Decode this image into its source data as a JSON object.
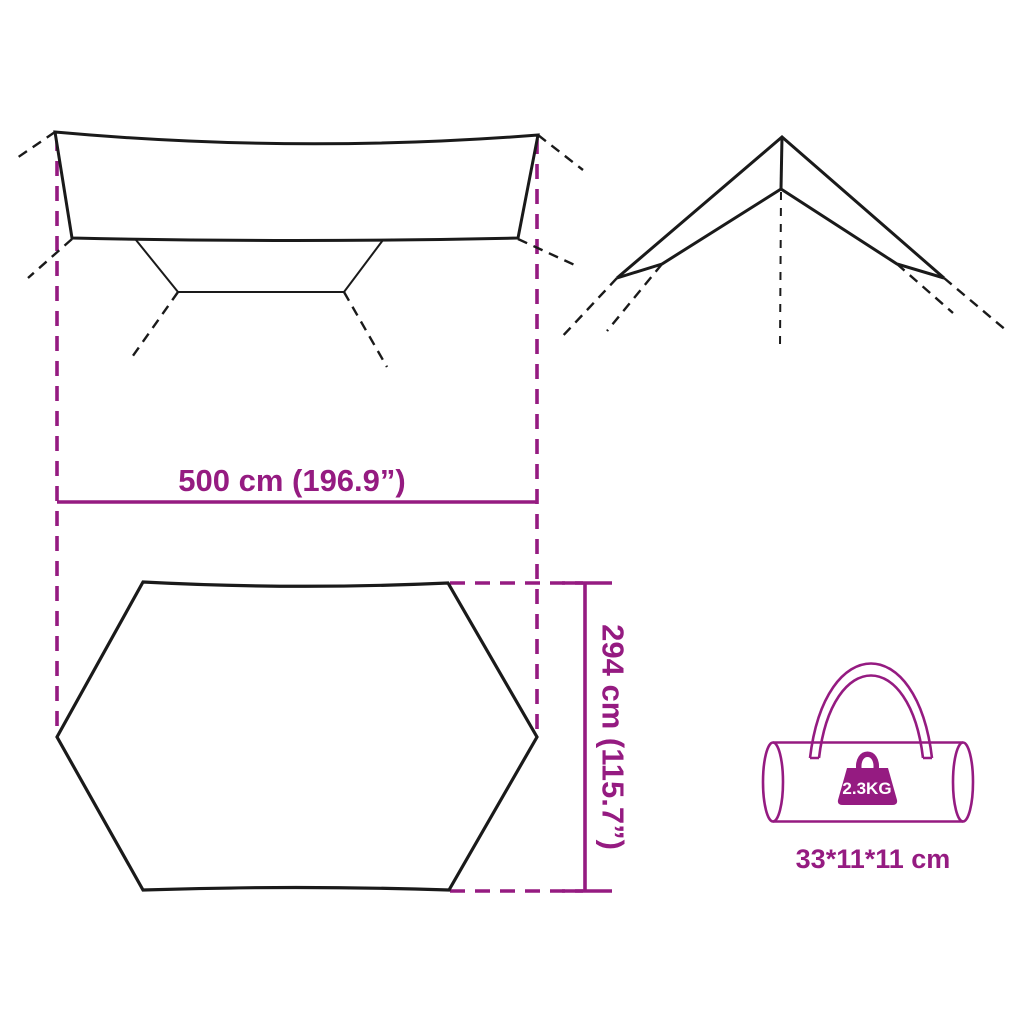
{
  "colors": {
    "accent": "#951b81",
    "line": "#1a1a1a",
    "background": "#ffffff",
    "weight_text": "#ffffff"
  },
  "dimensions": {
    "width_label": "500 cm (196.9”)",
    "width_cm": 500,
    "width_inches": 196.9,
    "depth_label": "294 cm (115.7”)",
    "depth_cm": 294,
    "depth_inches": 115.7
  },
  "package": {
    "weight_label": "2.3KG",
    "weight_kg": 2.3,
    "bag_size_label": "33*11*11 cm"
  },
  "icons": {
    "front_view": "tarp-front-view",
    "end_view": "tarp-end-view",
    "top_view": "tarp-top-view-hexagon",
    "bag": "carry-bag-icon",
    "weight": "weight-icon"
  }
}
